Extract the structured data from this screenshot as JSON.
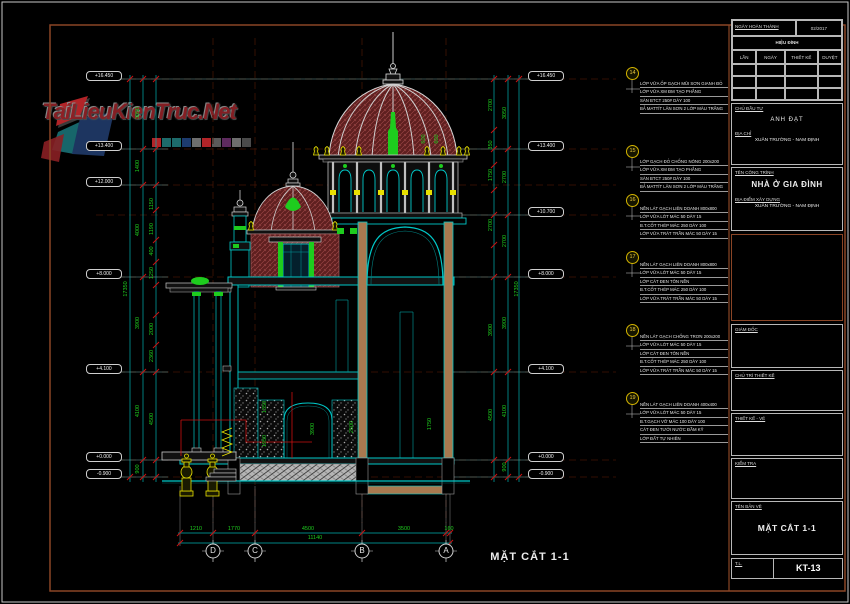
{
  "watermark": {
    "brand": "TaiLieuKienTruc.Net",
    "palette": [
      "#b32428",
      "#1d6b6b",
      "#1d6b6b",
      "#1d3b6e",
      "#6e6e6e",
      "#b32428",
      "#5a5a5a",
      "#5e2a5e",
      "#6e6e6e",
      "#4a4a4a"
    ]
  },
  "colors": {
    "line_cyan": "#00c8c8",
    "dim_green": "#1ecc1e",
    "accent_yellow": "#e8e000",
    "brick_red": "#5e1f1f",
    "frame_brown": "#8a4526",
    "watermark_red": "#8c2025"
  },
  "drawing": {
    "section_label": "MẶT CẮT 1-1",
    "grid_bubbles": [
      "D",
      "C",
      "B",
      "A"
    ],
    "elevations_left": [
      "+16.450",
      "+13.400",
      "+12.000",
      "+8.000",
      "+4.100",
      "+0.000",
      "-0.900"
    ],
    "elevations_right": [
      "+16.450",
      "+13.400",
      "+10.700",
      "+8.000",
      "+4.100",
      "+0.000",
      "-0.900"
    ],
    "dims_bottom": {
      "segments": [
        "1210",
        "1770",
        "4500",
        "3500",
        "160"
      ],
      "total": "11140"
    },
    "dims_left": {
      "total": "17350",
      "segments": [
        "3050",
        "1400",
        "4000",
        "3900",
        "4100",
        "900"
      ],
      "sub": [
        "1150",
        "1190",
        "400",
        "1250",
        "2000",
        "2360",
        "4500"
      ]
    },
    "dims_right": {
      "total": "17350",
      "segments": [
        "3050",
        "2700",
        "2700",
        "3900",
        "4100",
        "900"
      ],
      "sub": [
        "2700",
        "350",
        "1750",
        "2700",
        "3900",
        "4500"
      ]
    },
    "room_dims": [
      "1350",
      "1950",
      "3900",
      "2500",
      "1750",
      "600",
      "600"
    ],
    "notes": [
      {
        "num": "14",
        "lines": [
          "LỚP VỮA ỐP GẠCH MŨI SƠN GIANH ĐỎ",
          "LỚP VỮA XM ĐM TẠO PHẲNG",
          "SÀN BTCT 250# DÀY 100",
          "BẢ MATTÍT LĂN SƠN 2 LỚP MÀU TRẮNG"
        ]
      },
      {
        "num": "15",
        "lines": [
          "LỚP GẠCH ĐỎ CHỐNG NÓNG 200x200",
          "LỚP VỮA XM ĐM TẠO PHẲNG",
          "SÀN BTCT 250# DÀY 100",
          "BẢ MATTÍT LĂN SƠN 2 LỚP MÀU TRẮNG"
        ]
      },
      {
        "num": "16",
        "lines": [
          "NỀN LÁT GẠCH LIÊN DOANH 800x800",
          "LỚP VỮA LÓT MÁC 50 DÀY 15",
          "B.T.CỐT THÉP MÁC 250 DÀY 100",
          "LỚP VỮA TRÁT TRẦN MÁC 50 DÀY 15"
        ]
      },
      {
        "num": "17",
        "lines": [
          "NỀN LÁT GẠCH LIÊN DOANH 800x800",
          "LỚP VỮA LÓT MÁC 50 DÀY 15",
          "LỚP CÁT ĐEN TÔN NỀN",
          "B.T.CỐT THÉP MÁC 250 DÀY 100",
          "LỚP VỮA TRÁT TRẦN MÁC 50 DÀY 15"
        ]
      },
      {
        "num": "18",
        "lines": [
          "NỀN LÁT GẠCH CHỐNG TRƠN 200x200",
          "LỚP VỮA LÓT MÁC 50 DÀY 15",
          "LỚP CÁT ĐEN TÔN NỀN",
          "B.T.CỐT THÉP MÁC 250 DÀY 100",
          "LỚP VỮA TRÁT TRẦN MÁC 50 DÀY 15"
        ]
      },
      {
        "num": "19",
        "lines": [
          "NỀN LÁT GẠCH LIÊN DOANH 400x400",
          "LỚP VỮA LÓT MÁC 50 DÀY 15",
          "B.T.GẠCH VỠ MÁC 100 DÀY 100",
          "CÁT ĐEN TƯỚI NƯỚC ĐẦM KỸ",
          "LỚP ĐẤT TỰ NHIÊN"
        ]
      }
    ]
  },
  "titleblock": {
    "completed_label": "NGÀY HOÀN THÀNH",
    "completed_value": "02/2017",
    "revision_title": "HIỆU ĐÍNH",
    "revision_columns": [
      "LẦN",
      "NGÀY",
      "THIẾT KẾ",
      "DUYỆT"
    ],
    "investor_label": "CHỦ ĐẦU TƯ",
    "investor_value": "ANH ĐẠT",
    "address_label": "ĐỊA CHỈ",
    "address_value": "XUÂN TRƯỜNG - NAM ĐỊNH",
    "project_label": "TÊN CÔNG TRÌNH",
    "project_value": "NHÀ Ở GIA ĐÌNH",
    "location_label": "ĐỊA ĐIỂM XÂY DỰNG",
    "location_value": "XUÂN TRƯỜNG - NAM ĐỊNH",
    "role_director": "GIÁM ĐỐC",
    "role_lead": "CHỦ TRÌ THIẾT KẾ",
    "role_design": "THIẾT KẾ - VẼ",
    "role_check": "KIỂM TRA",
    "drawing_name_label": "TÊN BẢN VẼ",
    "drawing_name_value": "MẶT CẮT 1-1",
    "scale_label": "T.L.",
    "sheet_number": "KT-13"
  }
}
